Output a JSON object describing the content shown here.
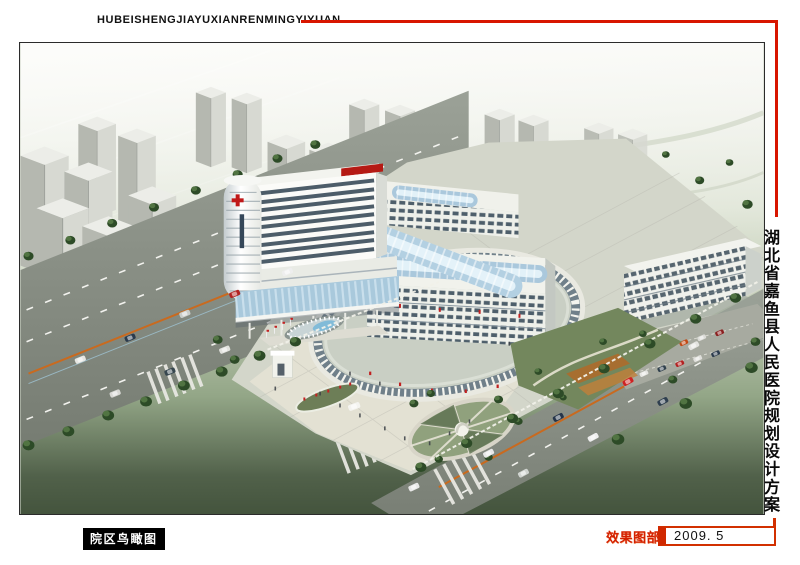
{
  "header": {
    "title": "HUBEISHENGJIAYUXIANRENMINGYIYUAN",
    "line_color": "#d81600"
  },
  "side_panel": {
    "title": "湖北省嘉鱼县人民医院规划设计方案",
    "line_color": "#d81600"
  },
  "viewport_label": {
    "text": "院区鸟瞰图",
    "bg": "#000000",
    "fg": "#ffffff"
  },
  "footer": {
    "section_label": "效果图部分",
    "section_label_color": "#d42000",
    "date": "2009. 5",
    "date_box_border": "#d23000"
  }
}
